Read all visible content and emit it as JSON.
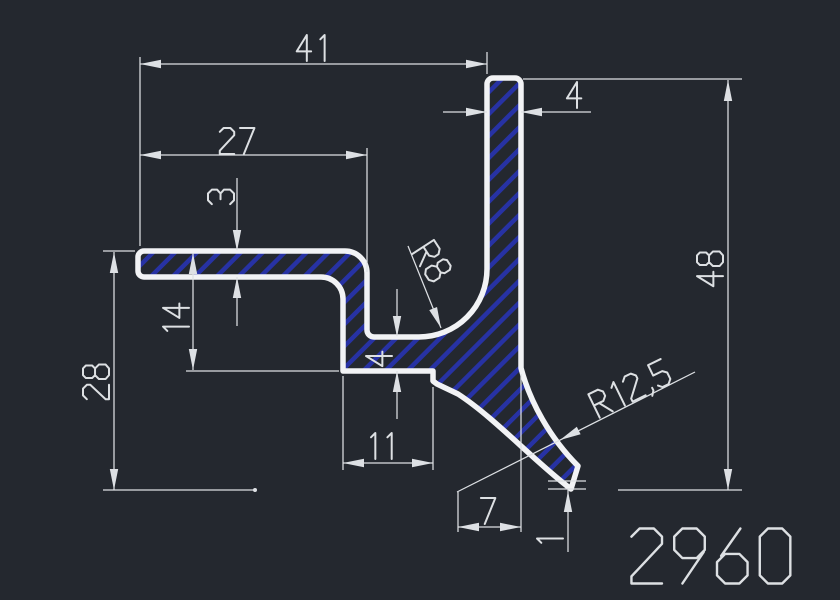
{
  "drawing": {
    "type": "profile-cross-section",
    "part_number": "2960",
    "colors": {
      "background": "#24282f",
      "outline": "#f2f3f5",
      "dim_line": "#dde0e4",
      "text": "#dde0e3",
      "hatch": "#2732a4"
    },
    "dimensions": [
      {
        "id": "d41",
        "label": "41",
        "type": "linear"
      },
      {
        "id": "d27",
        "label": "27",
        "type": "linear"
      },
      {
        "id": "d3",
        "label": "3",
        "type": "linear"
      },
      {
        "id": "d4t",
        "label": "4",
        "type": "linear"
      },
      {
        "id": "d14",
        "label": "14",
        "type": "linear"
      },
      {
        "id": "d28",
        "label": "28",
        "type": "linear"
      },
      {
        "id": "d4s",
        "label": "4",
        "type": "linear"
      },
      {
        "id": "d48",
        "label": "48",
        "type": "linear"
      },
      {
        "id": "d11",
        "label": "11",
        "type": "linear"
      },
      {
        "id": "d7",
        "label": "7",
        "type": "linear"
      },
      {
        "id": "d1",
        "label": "1",
        "type": "linear"
      },
      {
        "id": "r8",
        "label": "R8",
        "type": "radius"
      },
      {
        "id": "r125",
        "label": "R12,5",
        "type": "radius"
      }
    ]
  }
}
